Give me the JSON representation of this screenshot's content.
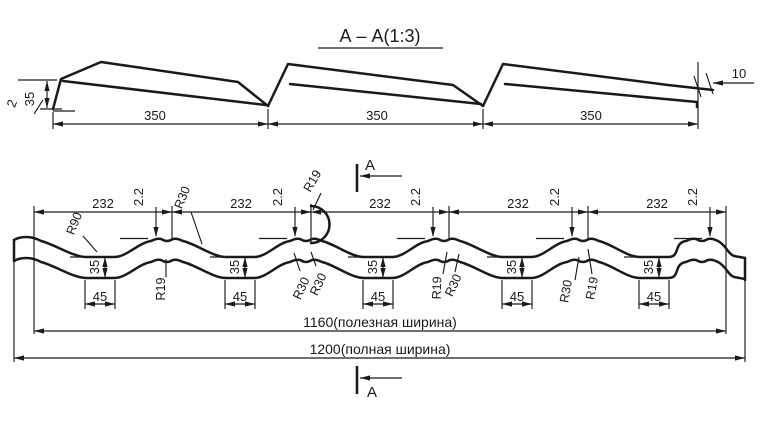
{
  "title": "А – А(1:3)",
  "section_view": {
    "module_lengths": [
      "350",
      "350",
      "350"
    ],
    "step_height": "35",
    "sheet_thickness": "2",
    "edge_overlap": "10"
  },
  "profile_view": {
    "pitches": [
      "232",
      "232",
      "232",
      "232",
      "232"
    ],
    "crest_steps": [
      "2.2",
      "2.2",
      "2.2",
      "2.2",
      "2.2"
    ],
    "wave_heights": [
      "35",
      "35",
      "35",
      "35",
      "35"
    ],
    "groove_widths": [
      "45",
      "45",
      "45",
      "45",
      "45"
    ],
    "radii": {
      "r90": "R90",
      "r30_top": "R30",
      "r19_arc": "R19",
      "r19_c1": "R19",
      "r30_c2a": "R30",
      "r30_c2b": "R30",
      "r19_c4": "R19",
      "r30_c4": "R30",
      "r30_c5": "R30",
      "r19_c5": "R19"
    },
    "useful_width": "1160(полезная ширина)",
    "full_width": "1200(полная ширина)"
  },
  "section_markers": {
    "top": "А",
    "bottom": "А"
  },
  "colors": {
    "line": "#1a1a1a",
    "background": "#ffffff"
  }
}
